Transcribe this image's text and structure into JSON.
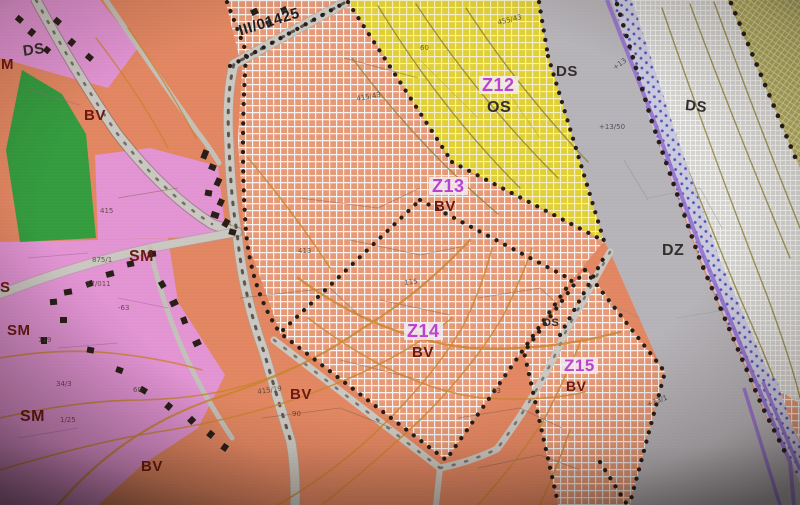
{
  "map": {
    "road_ref": "III/01425",
    "zones": [
      {
        "id": "Z12",
        "use": "OS"
      },
      {
        "id": "Z13",
        "use": "BV"
      },
      {
        "id": "Z14",
        "use": "BV"
      },
      {
        "id": "Z15",
        "use": "BV"
      }
    ],
    "area_codes": [
      "BV",
      "SM",
      "OS",
      "DS",
      "DZ"
    ],
    "labels": [
      {
        "text": "III/01425",
        "x": 237,
        "y": 24,
        "size": 15,
        "rot": -17,
        "cls": "road"
      },
      {
        "text": "DS",
        "x": 22,
        "y": 44,
        "size": 15,
        "rot": -8,
        "cls": "dark"
      },
      {
        "text": "M",
        "x": 1,
        "y": 57,
        "size": 15,
        "rot": 0,
        "cls": "maroon"
      },
      {
        "text": "BV",
        "x": 84,
        "y": 108,
        "size": 15,
        "rot": 0,
        "cls": "maroon"
      },
      {
        "text": "Z12",
        "x": 479,
        "y": 76,
        "size": 18,
        "rot": 0,
        "cls": "zone"
      },
      {
        "text": "OS",
        "x": 487,
        "y": 100,
        "size": 16,
        "rot": 0,
        "cls": "dark"
      },
      {
        "text": "DS",
        "x": 556,
        "y": 64,
        "size": 15,
        "rot": 0,
        "cls": "dark"
      },
      {
        "text": "DS",
        "x": 686,
        "y": 98,
        "size": 15,
        "rot": 6,
        "cls": "dark"
      },
      {
        "text": "Z13",
        "x": 429,
        "y": 177,
        "size": 18,
        "rot": 0,
        "cls": "zone"
      },
      {
        "text": "BV",
        "x": 434,
        "y": 199,
        "size": 15,
        "rot": 0,
        "cls": "maroon"
      },
      {
        "text": "DZ",
        "x": 662,
        "y": 243,
        "size": 16,
        "rot": 0,
        "cls": "dark"
      },
      {
        "text": "SM",
        "x": 129,
        "y": 249,
        "size": 16,
        "rot": 0,
        "cls": "maroon"
      },
      {
        "text": "S",
        "x": 0,
        "y": 280,
        "size": 15,
        "rot": 0,
        "cls": "maroon"
      },
      {
        "text": "SM",
        "x": 7,
        "y": 323,
        "size": 15,
        "rot": 0,
        "cls": "maroon"
      },
      {
        "text": "Z14",
        "x": 404,
        "y": 322,
        "size": 18,
        "rot": 0,
        "cls": "zone"
      },
      {
        "text": "BV",
        "x": 412,
        "y": 345,
        "size": 15,
        "rot": 0,
        "cls": "maroon"
      },
      {
        "text": "DS",
        "x": 543,
        "y": 318,
        "size": 11,
        "rot": 0,
        "cls": "dark"
      },
      {
        "text": "Z15",
        "x": 561,
        "y": 357,
        "size": 17,
        "rot": 0,
        "cls": "zone"
      },
      {
        "text": "BV",
        "x": 566,
        "y": 379,
        "size": 14,
        "rot": 0,
        "cls": "maroon"
      },
      {
        "text": "SM",
        "x": 20,
        "y": 409,
        "size": 16,
        "rot": 0,
        "cls": "maroon"
      },
      {
        "text": "BV",
        "x": 290,
        "y": 387,
        "size": 15,
        "rot": 0,
        "cls": "maroon"
      },
      {
        "text": "BV",
        "x": 141,
        "y": 459,
        "size": 15,
        "rot": 0,
        "cls": "maroon"
      }
    ],
    "parcel_numbers": [
      {
        "text": "455/43",
        "x": 497,
        "y": 20,
        "rot": -14,
        "cls": ""
      },
      {
        "text": "+13/50",
        "x": 599,
        "y": 124,
        "rot": 0,
        "cls": "p-dark"
      },
      {
        "text": "+13",
        "x": 612,
        "y": 66,
        "rot": -35,
        "cls": "p-dark"
      },
      {
        "text": "415",
        "x": 100,
        "y": 208,
        "rot": 0,
        "cls": ""
      },
      {
        "text": "875/1",
        "x": 92,
        "y": 257,
        "rot": 0,
        "cls": ""
      },
      {
        "text": "57/011",
        "x": 86,
        "y": 281,
        "rot": 0,
        "cls": ""
      },
      {
        "text": "119",
        "x": 38,
        "y": 337,
        "rot": 0,
        "cls": ""
      },
      {
        "text": "-63",
        "x": 118,
        "y": 305,
        "rot": 0,
        "cls": ""
      },
      {
        "text": "415/19",
        "x": 257,
        "y": 389,
        "rot": -8,
        "cls": ""
      },
      {
        "text": "90",
        "x": 292,
        "y": 411,
        "rot": 0,
        "cls": ""
      },
      {
        "text": "34/3",
        "x": 56,
        "y": 381,
        "rot": 0,
        "cls": ""
      },
      {
        "text": "1/25",
        "x": 60,
        "y": 417,
        "rot": 0,
        "cls": ""
      },
      {
        "text": "60",
        "x": 133,
        "y": 387,
        "rot": 0,
        "cls": ""
      },
      {
        "text": "53",
        "x": 492,
        "y": 388,
        "rot": 0,
        "cls": ""
      },
      {
        "text": "115",
        "x": 404,
        "y": 280,
        "rot": -6,
        "cls": ""
      },
      {
        "text": "413",
        "x": 298,
        "y": 248,
        "rot": 0,
        "cls": ""
      },
      {
        "text": "+73/1",
        "x": 646,
        "y": 402,
        "rot": -20,
        "cls": "p-dark"
      },
      {
        "text": "415/43",
        "x": 356,
        "y": 96,
        "rot": -10,
        "cls": ""
      },
      {
        "text": "60",
        "x": 420,
        "y": 45,
        "rot": 0,
        "cls": ""
      }
    ],
    "colors": {
      "bv_salmon": "#e8875f",
      "sm_pink": "#e894d8",
      "os_yellow": "#e6d42e",
      "greenery": "#2f9e3b",
      "transport_gray": "#b9b6bb",
      "road_gray": "#cdcac3",
      "corridor_hatch": "#d8d7d3",
      "olive_zone": "#afa957",
      "utility_purple": "#9672d2",
      "contour_orange": "#cf8428",
      "boundary_dot": "#241a12",
      "zone_label_magenta": "#bf3fd6",
      "label_maroon": "#6d150d",
      "label_dark": "#2f2a28"
    }
  }
}
